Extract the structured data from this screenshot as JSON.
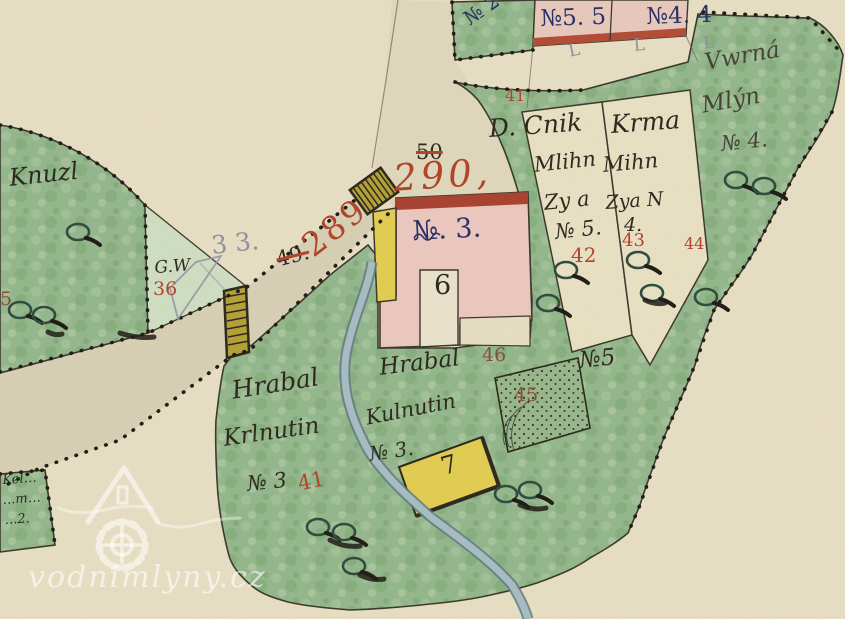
{
  "map_title": "historic cadastral mill map",
  "watermark": {
    "text": "vodnimlyny.cz"
  },
  "palette": {
    "paper": "#e7dfc4",
    "road": "#d8d0b5",
    "meadow_green": "#93b78c",
    "light_green": "#cfdec2",
    "building_pink": "#ecc8bf",
    "building_yellow": "#e2cd50",
    "stream_blue": "#a7bcc2",
    "ink": "#2e2a20",
    "ink2": "#47433a",
    "red": "#b0452c",
    "navy": "#2b3166",
    "pencil": "#8f91a0",
    "brown": "#85503a"
  },
  "map_labels": [
    {
      "id": "knuzl",
      "text": "Knuzl",
      "x": 8,
      "y": 166,
      "size": 24,
      "color": "ink",
      "rot": -6,
      "cls": "cursive"
    },
    {
      "id": "gw",
      "text": "G.W",
      "x": 154,
      "y": 260,
      "size": 17,
      "color": "ink",
      "rot": -4,
      "cls": "cursive"
    },
    {
      "id": "no36",
      "text": "36",
      "x": 153,
      "y": 280,
      "size": 19,
      "color": "red",
      "rot": 0,
      "cls": "print"
    },
    {
      "id": "pencil33",
      "text": "3 3.",
      "x": 210,
      "y": 233,
      "size": 25,
      "color": "pencil",
      "rot": -6,
      "cls": "print"
    },
    {
      "id": "no289",
      "text": "289",
      "x": 296,
      "y": 236,
      "size": 33,
      "color": "red",
      "rot": -38,
      "cls": "print",
      "ls": 3
    },
    {
      "id": "no49",
      "text": "49.",
      "x": 274,
      "y": 250,
      "size": 21,
      "color": "ink",
      "rot": -14,
      "cls": "print",
      "strike": true
    },
    {
      "id": "no50",
      "text": "50",
      "x": 416,
      "y": 142,
      "size": 21,
      "color": "ink",
      "rot": 0,
      "cls": "print",
      "strike": true
    },
    {
      "id": "no290",
      "text": "290,",
      "x": 392,
      "y": 160,
      "size": 37,
      "color": "red",
      "rot": -4,
      "cls": "cursive",
      "ls": 4
    },
    {
      "id": "mill-number",
      "text": "№. 3.",
      "x": 412,
      "y": 218,
      "size": 27,
      "color": "navy",
      "rot": -3,
      "cls": "print"
    },
    {
      "id": "no6",
      "text": "6",
      "x": 434,
      "y": 272,
      "size": 27,
      "color": "ink",
      "rot": 0,
      "cls": "print"
    },
    {
      "id": "no7",
      "text": "7",
      "x": 438,
      "y": 455,
      "size": 25,
      "color": "ink",
      "rot": -16,
      "cls": "print"
    },
    {
      "id": "hrabal-west",
      "text": "Hrabal",
      "x": 230,
      "y": 378,
      "size": 25,
      "color": "ink",
      "rot": -9,
      "cls": "cursive"
    },
    {
      "id": "krlnutin-west",
      "text": "Krlnutin",
      "x": 222,
      "y": 428,
      "size": 23,
      "color": "ink",
      "rot": -8,
      "cls": "cursive"
    },
    {
      "id": "no3-west",
      "text": "№ 3",
      "x": 246,
      "y": 474,
      "size": 21,
      "color": "ink",
      "rot": -6,
      "cls": "cursive"
    },
    {
      "id": "no41-west",
      "text": "41",
      "x": 296,
      "y": 474,
      "size": 21,
      "color": "red",
      "rot": -12,
      "cls": "print"
    },
    {
      "id": "hrabal-east",
      "text": "Hrabal",
      "x": 378,
      "y": 357,
      "size": 23,
      "color": "ink",
      "rot": -7,
      "cls": "cursive"
    },
    {
      "id": "kulnutin-east",
      "text": "Kulnutin",
      "x": 364,
      "y": 408,
      "size": 21,
      "color": "ink",
      "rot": -11,
      "cls": "cursive"
    },
    {
      "id": "no3-east",
      "text": "№ 3.",
      "x": 368,
      "y": 444,
      "size": 20,
      "color": "ink",
      "rot": -8,
      "cls": "cursive"
    },
    {
      "id": "dcnik",
      "text": "D. Cnik",
      "x": 488,
      "y": 116,
      "size": 25,
      "color": "ink",
      "rot": -4,
      "cls": "cursive"
    },
    {
      "id": "dcnik-2",
      "text": "Mlihn",
      "x": 533,
      "y": 155,
      "size": 21,
      "color": "ink",
      "rot": -6,
      "cls": "cursive"
    },
    {
      "id": "dcnik-3",
      "text": "Zy a",
      "x": 543,
      "y": 193,
      "size": 21,
      "color": "ink",
      "rot": -6,
      "cls": "cursive"
    },
    {
      "id": "dcnik-4",
      "text": "№ 5.",
      "x": 554,
      "y": 222,
      "size": 21,
      "color": "ink",
      "rot": -6,
      "cls": "cursive"
    },
    {
      "id": "no42",
      "text": "42",
      "x": 571,
      "y": 245,
      "size": 20,
      "color": "red",
      "rot": 0,
      "cls": "print"
    },
    {
      "id": "krma",
      "text": "Krma",
      "x": 610,
      "y": 112,
      "size": 25,
      "color": "ink",
      "rot": -4,
      "cls": "cursive"
    },
    {
      "id": "krma-2",
      "text": "Mihn",
      "x": 602,
      "y": 155,
      "size": 21,
      "color": "ink",
      "rot": -5,
      "cls": "cursive"
    },
    {
      "id": "krma-3",
      "text": "Zya N",
      "x": 605,
      "y": 194,
      "size": 19,
      "color": "ink",
      "rot": -4,
      "cls": "cursive"
    },
    {
      "id": "krma-4",
      "text": "4.",
      "x": 624,
      "y": 216,
      "size": 19,
      "color": "ink",
      "rot": 0,
      "cls": "cursive"
    },
    {
      "id": "no43",
      "text": "43",
      "x": 622,
      "y": 232,
      "size": 18,
      "color": "red",
      "rot": 0,
      "cls": "print"
    },
    {
      "id": "vrana-1",
      "text": "Vwrná",
      "x": 703,
      "y": 52,
      "size": 23,
      "color": "ink2",
      "rot": -10,
      "cls": "cursive"
    },
    {
      "id": "vrana-2",
      "text": "Mlýn",
      "x": 700,
      "y": 95,
      "size": 23,
      "color": "ink2",
      "rot": -10,
      "cls": "cursive"
    },
    {
      "id": "vrana-3",
      "text": "№ 4.",
      "x": 720,
      "y": 134,
      "size": 21,
      "color": "ink2",
      "rot": -6,
      "cls": "cursive"
    },
    {
      "id": "no44",
      "text": "44",
      "x": 684,
      "y": 236,
      "size": 16,
      "color": "red",
      "rot": 0,
      "cls": "print"
    },
    {
      "id": "no55-strip",
      "text": "№5. 5",
      "x": 540,
      "y": 8,
      "size": 23,
      "color": "navy",
      "rot": -2,
      "cls": "print"
    },
    {
      "id": "no44-strip",
      "text": "№4. 4",
      "x": 646,
      "y": 6,
      "size": 23,
      "color": "navy",
      "rot": -2,
      "cls": "print"
    },
    {
      "id": "no2-top",
      "text": "№ 2",
      "x": 460,
      "y": 12,
      "size": 20,
      "color": "navy",
      "rot": -35,
      "cls": "print"
    },
    {
      "id": "no41-top",
      "text": "41",
      "x": 505,
      "y": 88,
      "size": 16,
      "color": "red",
      "rot": 0,
      "cls": "print"
    },
    {
      "id": "no5-big",
      "text": "№5",
      "x": 578,
      "y": 350,
      "size": 23,
      "color": "ink",
      "rot": -6,
      "cls": "cursive"
    },
    {
      "id": "no45",
      "text": "45",
      "x": 514,
      "y": 386,
      "size": 19,
      "color": "brown",
      "rot": 0,
      "cls": "print"
    },
    {
      "id": "no46",
      "text": "46",
      "x": 482,
      "y": 346,
      "size": 19,
      "color": "brown",
      "rot": 0,
      "cls": "print"
    },
    {
      "id": "no5-left",
      "text": "5",
      "x": 0,
      "y": 290,
      "size": 19,
      "color": "brown",
      "rot": 0,
      "cls": "print"
    },
    {
      "id": "corner-mark-1",
      "text": "L",
      "x": 567,
      "y": 44,
      "size": 17,
      "color": "pencil",
      "rot": -12,
      "cls": "print"
    },
    {
      "id": "corner-mark-2",
      "text": "L",
      "x": 633,
      "y": 38,
      "size": 17,
      "color": "pencil",
      "rot": -5,
      "cls": "print"
    },
    {
      "id": "corner-mark-3",
      "text": "L",
      "x": 702,
      "y": 36,
      "size": 17,
      "color": "pencil",
      "rot": -8,
      "cls": "print"
    },
    {
      "id": "bl-parcel-1",
      "text": "Kel…",
      "x": 2,
      "y": 474,
      "size": 13,
      "color": "ink",
      "rot": -4,
      "cls": "cursive"
    },
    {
      "id": "bl-parcel-2",
      "text": "…m…",
      "x": 2,
      "y": 494,
      "size": 13,
      "color": "ink",
      "rot": -4,
      "cls": "cursive"
    },
    {
      "id": "bl-parcel-3",
      "text": "…2.",
      "x": 4,
      "y": 514,
      "size": 13,
      "color": "ink",
      "rot": -4,
      "cls": "cursive"
    }
  ]
}
